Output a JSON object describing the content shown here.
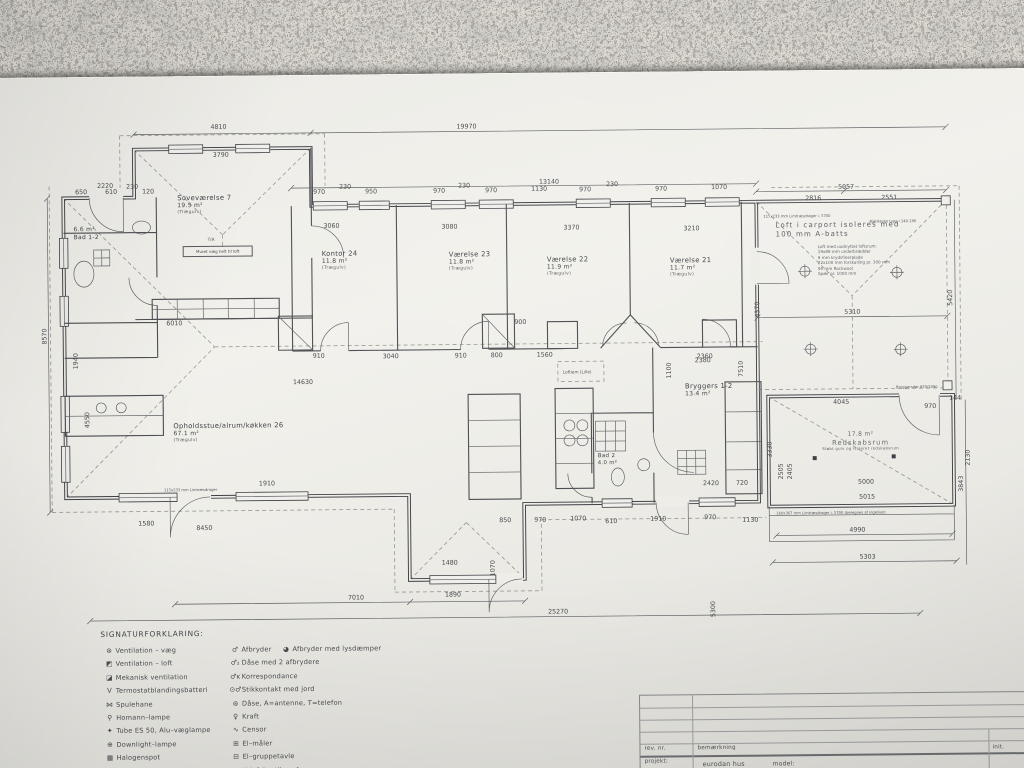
{
  "plan": {
    "rooms": [
      {
        "name": "Soveværelse 7",
        "area": "19.5 m²",
        "floor": "(Trægulv)"
      },
      {
        "name": "Bad 1-2",
        "area": "6.6 m²",
        "floor": ""
      },
      {
        "name": "Kontor 24",
        "area": "11.8 m²",
        "floor": "(Trægulv)"
      },
      {
        "name": "Værelse 23",
        "area": "11.8 m²",
        "floor": "(Trægulv)"
      },
      {
        "name": "Værelse 22",
        "area": "11.9 m²",
        "floor": "(Trægulv)"
      },
      {
        "name": "Værelse 21",
        "area": "11.7 m²",
        "floor": "(Trægulv)"
      },
      {
        "name": "Opholdsstue/alrum/køkken 26",
        "area": "67.1 m²",
        "floor": "(Trægulv)"
      },
      {
        "name": "Bad 2",
        "area": "4.0 m²",
        "floor": ""
      },
      {
        "name": "Bryggers 1-2",
        "area": "13.4 m²",
        "floor": ""
      },
      {
        "name": "Redskabsrum",
        "area": "17.8 m²",
        "floor": "Støbt gulv og isoleret redskabsrum"
      }
    ],
    "carport": {
      "line1": "Loft i carport isoleres med",
      "line2": "100 mm A-batts",
      "notes": [
        "Loft med uudnyttet loftsrum:",
        "19x88 mm underbrædder",
        "9 mm krydsfinerplade",
        "22x100 mm forskalling pr. 300 mm",
        "95 mm Rockwool",
        "Spær pr. 1000 mm"
      ]
    },
    "notes": {
      "muret": "Muret væg helt til loft",
      "loftlem": "Loftlem (Lille)",
      "ta": "T/A",
      "limtrae_top": "115x233 mm Limtræsdrager i. 5700",
      "bjaelkesko": "Bjælkesko type i 140-190",
      "limtrae_bottom": "115x233 mm Limtræsdrager",
      "limtrae_redskab": "160x367 mm Limtræsdrager i. 5700 (beregnes af ingeniør)",
      "bryggersdoer": "Bryggersdør 870/2090"
    },
    "dims": [
      "19970",
      "4810",
      "3790",
      "13140",
      "2220",
      "650",
      "610",
      "230",
      "120",
      "970",
      "230",
      "950",
      "970",
      "230",
      "970",
      "1130",
      "970",
      "230",
      "970",
      "1070",
      "5057",
      "2816",
      "2551",
      "3060",
      "3080",
      "3370",
      "3210",
      "8570",
      "4550",
      "1940",
      "6010",
      "14630",
      "910",
      "3040",
      "910",
      "800",
      "1560",
      "900",
      "2360",
      "1580",
      "8450",
      "1910",
      "7010",
      "1890",
      "1480",
      "1070",
      "25270",
      "5300",
      "850",
      "970",
      "1070",
      "610",
      "1910",
      "970",
      "1130",
      "2380",
      "3330",
      "2505",
      "2405",
      "4045",
      "970",
      "144",
      "5310",
      "5420",
      "4370",
      "2130",
      "3843",
      "5000",
      "5015",
      "4990",
      "5303",
      "2420",
      "720",
      "7510",
      "1100"
    ]
  },
  "legend": {
    "title": "SIGNATURFORKLARING:",
    "left": [
      {
        "icon": "⊛",
        "label": "Ventilation – væg"
      },
      {
        "icon": "◩",
        "label": "Ventilation – loft"
      },
      {
        "icon": "◪",
        "label": "Mekanisk ventilation"
      },
      {
        "icon": "V",
        "label": "Termostatblandingsbatteri"
      },
      {
        "icon": "⋈",
        "label": "Spulehane"
      },
      {
        "icon": "⚲",
        "label": "Homann–lampe"
      },
      {
        "icon": "✦",
        "label": "Tube ES 50, Alu–væglampe"
      },
      {
        "icon": "⊕",
        "label": "Downlight–lampe"
      },
      {
        "icon": "▦",
        "label": "Halogenspot"
      },
      {
        "icon": "◉",
        "label": "Skotlampe"
      }
    ],
    "right": [
      {
        "icon": "♂",
        "label": "Afbryder",
        "icon2": "◕",
        "label2": "Afbryder med lysdæmper"
      },
      {
        "icon": "♂₂",
        "label": "Dåse med 2 afbrydere"
      },
      {
        "icon": "♂ᴋ",
        "label": "Korrespondance"
      },
      {
        "icon": "⊙♂",
        "label": "Stikkontakt med jord"
      },
      {
        "icon": "⊛",
        "label": "Dåse,  A=antenne, T=telefon"
      },
      {
        "icon": "♀",
        "label": "Kraft"
      },
      {
        "icon": "∿",
        "label": "Censor"
      },
      {
        "icon": "⊞",
        "label": "El–måler"
      },
      {
        "icon": "⊟",
        "label": "El–gruppetavle"
      },
      {
        "icon": "⊠",
        "label": "Udeføler til gasfyr"
      }
    ]
  },
  "titleblock": {
    "rev_label": "rev. nr.",
    "bem_label": "bemærkning",
    "init_label": "init.",
    "projekt_label": "projekt:",
    "projekt_value": "eurodan hus",
    "model_label": "model:"
  }
}
